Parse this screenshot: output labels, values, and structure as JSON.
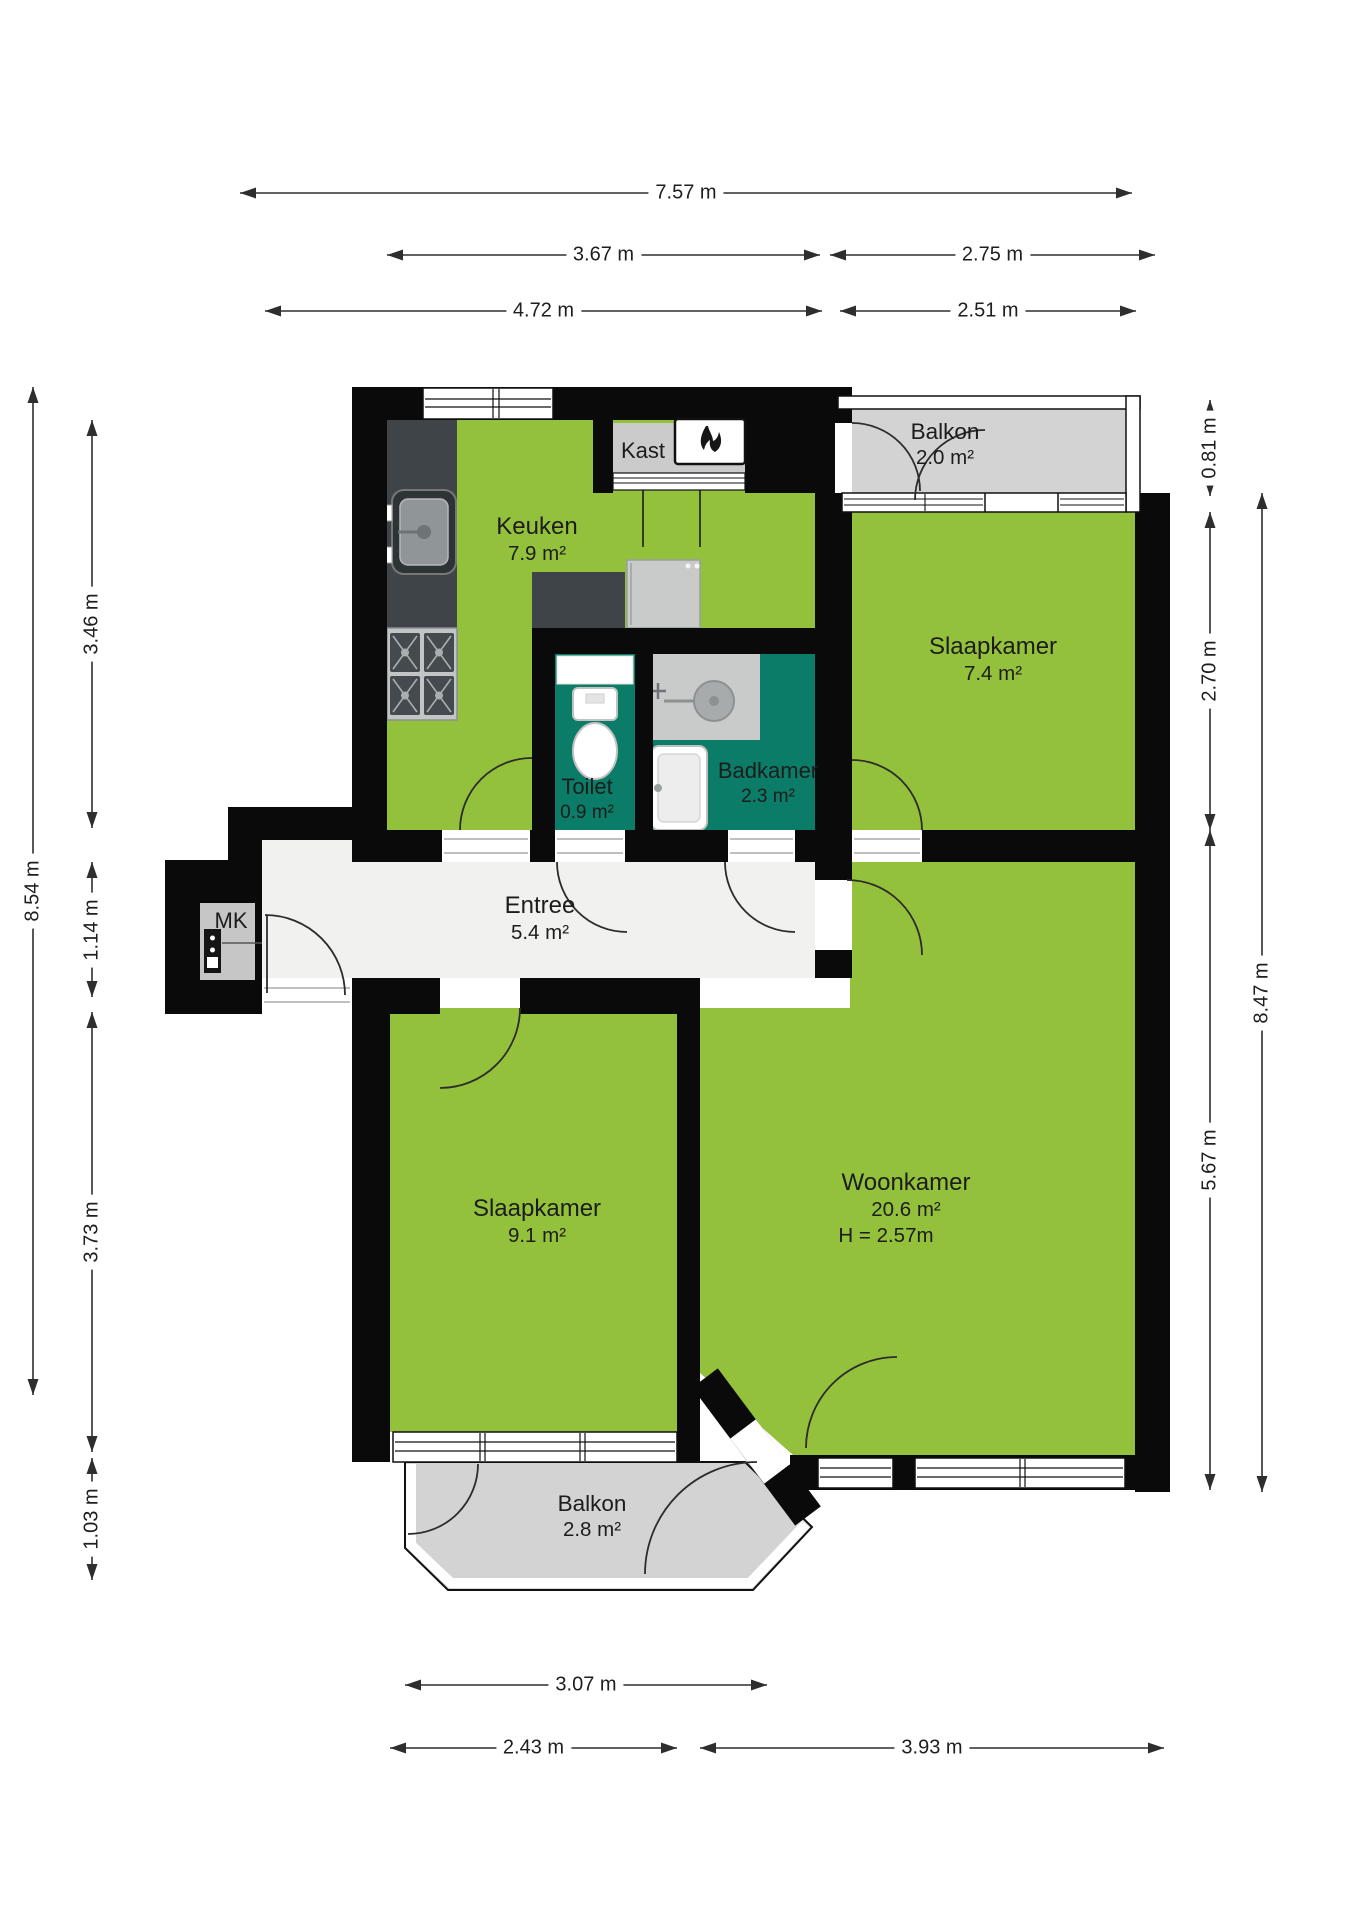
{
  "rooms": {
    "keuken": {
      "name": "Keuken",
      "area": "7.9 m²"
    },
    "kast": {
      "name": "Kast"
    },
    "balkon_boven": {
      "name": "Balkon",
      "area": "2.0 m²"
    },
    "slaapkamer_boven": {
      "name": "Slaapkamer",
      "area": "7.4 m²"
    },
    "toilet": {
      "name": "Toilet",
      "area": "0.9 m²"
    },
    "badkamer": {
      "name": "Badkamer",
      "area": "2.3 m²"
    },
    "entree": {
      "name": "Entree",
      "area": "5.4 m²"
    },
    "mk": {
      "name": "MK"
    },
    "slaapkamer_links": {
      "name": "Slaapkamer",
      "area": "9.1 m²"
    },
    "woonkamer": {
      "name": "Woonkamer",
      "area": "20.6 m²",
      "height": "H = 2.57m"
    },
    "balkon_onder": {
      "name": "Balkon",
      "area": "2.8 m²"
    }
  },
  "dimensions": [
    {
      "label": "7.57 m",
      "orient": "h",
      "x1": 240,
      "x2": 1132,
      "y": 193
    },
    {
      "label": "3.67 m",
      "orient": "h",
      "x1": 387,
      "x2": 820,
      "y": 255
    },
    {
      "label": "2.75 m",
      "orient": "h",
      "x1": 830,
      "x2": 1155,
      "y": 255
    },
    {
      "label": "4.72 m",
      "orient": "h",
      "x1": 265,
      "x2": 822,
      "y": 311
    },
    {
      "label": "2.51 m",
      "orient": "h",
      "x1": 840,
      "x2": 1136,
      "y": 311
    },
    {
      "label": "8.54 m",
      "orient": "v",
      "x": 33,
      "y1": 387,
      "y2": 1395
    },
    {
      "label": "3.46 m",
      "orient": "v",
      "x": 92,
      "y1": 420,
      "y2": 828
    },
    {
      "label": "1.14 m",
      "orient": "v",
      "x": 92,
      "y1": 862,
      "y2": 997
    },
    {
      "label": "3.73 m",
      "orient": "v",
      "x": 92,
      "y1": 1012,
      "y2": 1452
    },
    {
      "label": "1.03 m",
      "orient": "v",
      "x": 92,
      "y1": 1458,
      "y2": 1580
    },
    {
      "label": "0.81 m",
      "orient": "v",
      "x": 1210,
      "y1": 400,
      "y2": 496
    },
    {
      "label": "2.70 m",
      "orient": "v",
      "x": 1210,
      "y1": 512,
      "y2": 830
    },
    {
      "label": "8.47 m",
      "orient": "v",
      "x": 1262,
      "y1": 493,
      "y2": 1492
    },
    {
      "label": "5.67 m",
      "orient": "v",
      "x": 1210,
      "y1": 830,
      "y2": 1490
    },
    {
      "label": "3.07 m",
      "orient": "h",
      "x1": 405,
      "x2": 767,
      "y": 1685
    },
    {
      "label": "2.43 m",
      "orient": "h",
      "x1": 390,
      "x2": 677,
      "y": 1748
    },
    {
      "label": "3.93 m",
      "orient": "h",
      "x1": 700,
      "x2": 1164,
      "y": 1748
    }
  ],
  "colors": {
    "room_green": "#94C13C",
    "wet_room_teal": "#0B7C67",
    "balcony_gray": "#D3D3D3",
    "wall_black": "#0A0A0A",
    "hall_floor": "#F1F1EF",
    "counter_dark": "#3F4448",
    "cabinet_gray": "#CBCBCB",
    "dim_line": "#2E2E2E",
    "text": "#1C1C1C"
  }
}
